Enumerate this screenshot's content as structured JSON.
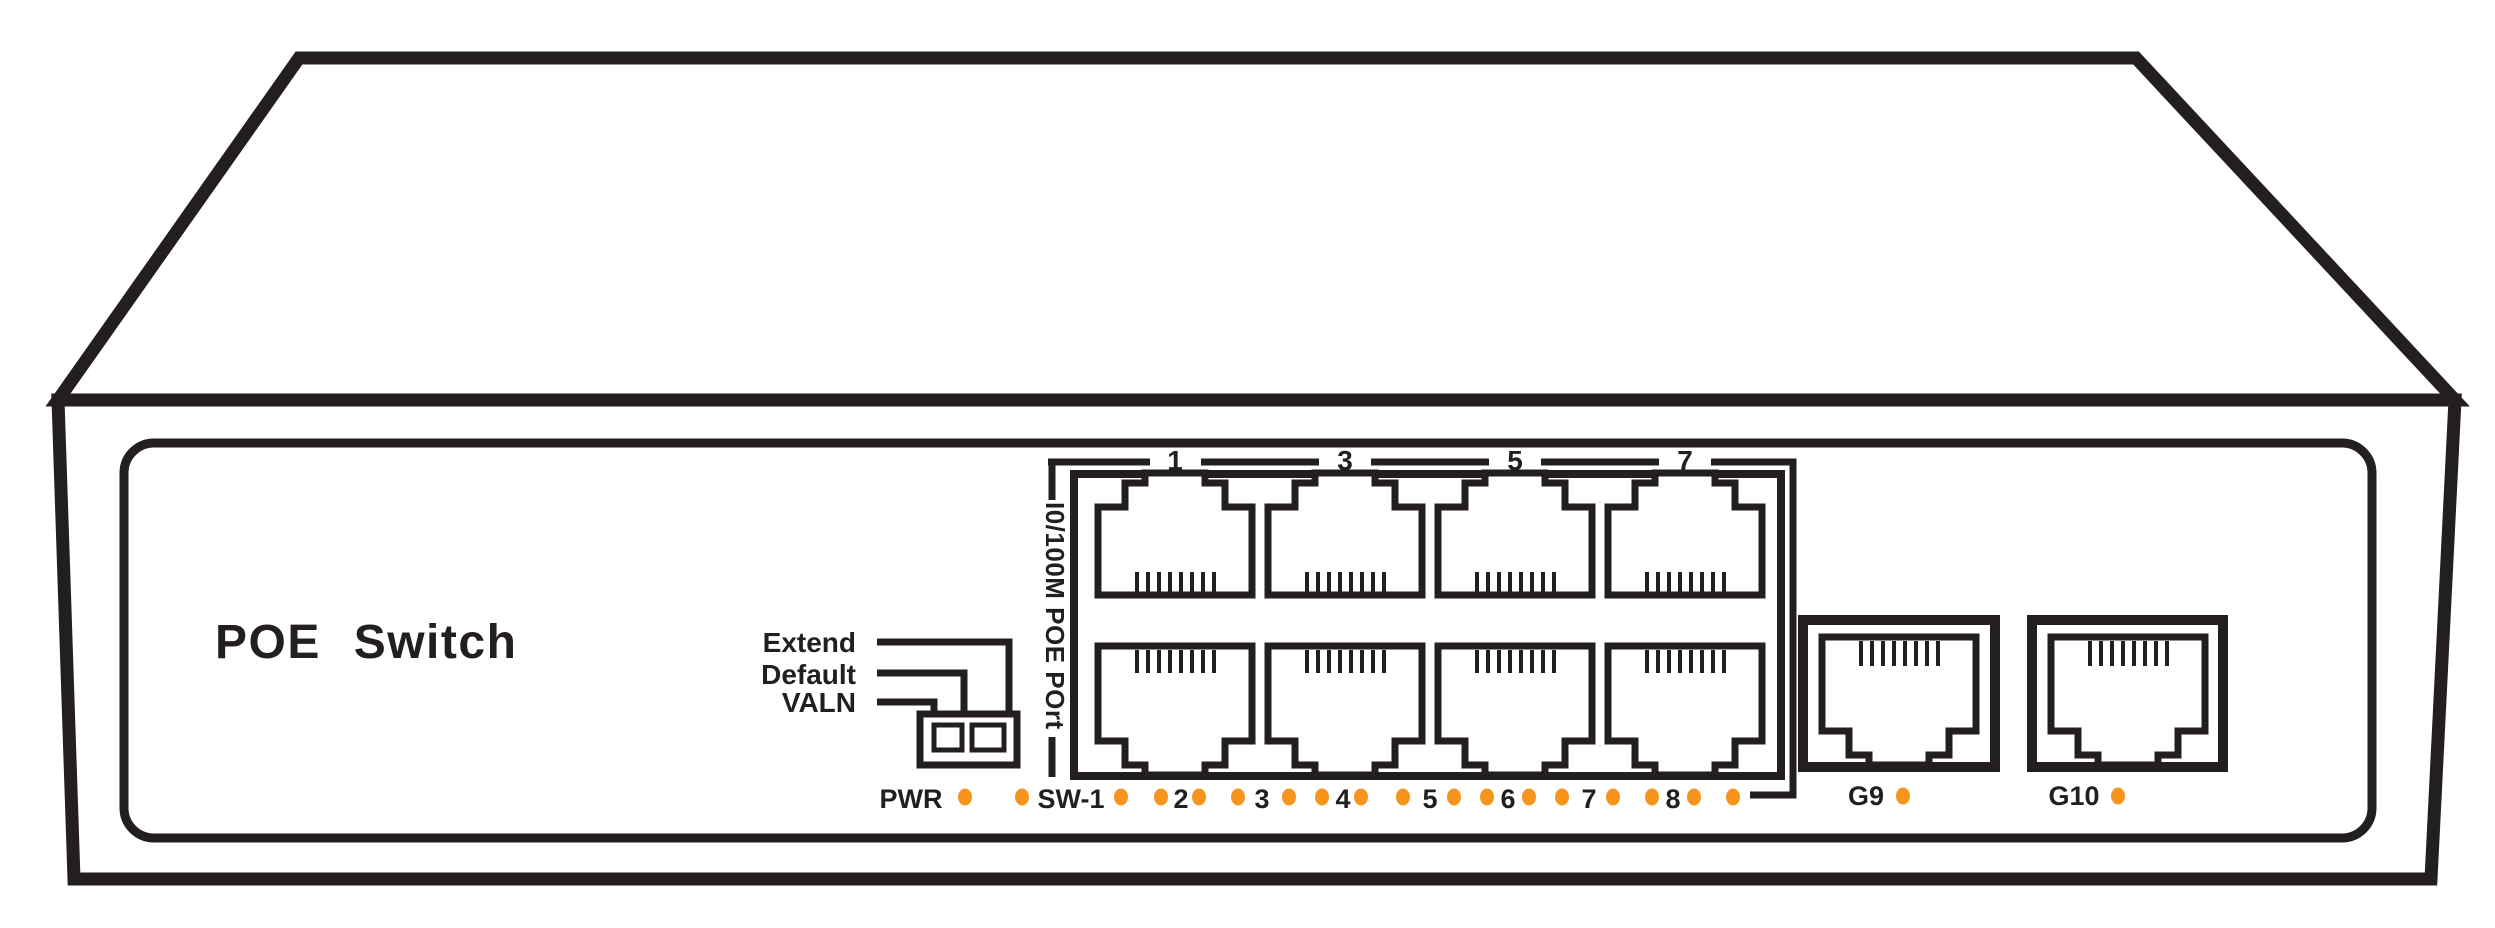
{
  "title": "POE Switch",
  "dip_switch": {
    "labels": [
      "Extend",
      "Default",
      "VALN"
    ]
  },
  "poe_port_block": {
    "bracket_label": "I0/100M POE POrt",
    "top_port_numbers": [
      "1",
      "3",
      "5",
      "7"
    ]
  },
  "led_row": {
    "power_label": "PWR",
    "switch_label": "SW-1",
    "port_numbers": [
      "2",
      "3",
      "4",
      "5",
      "6",
      "7",
      "8"
    ]
  },
  "uplink_ports": {
    "labels": [
      "G9",
      "G10"
    ]
  },
  "colors": {
    "line": "#231f20",
    "led_orange": "#f7941d",
    "background": "#ffffff"
  }
}
